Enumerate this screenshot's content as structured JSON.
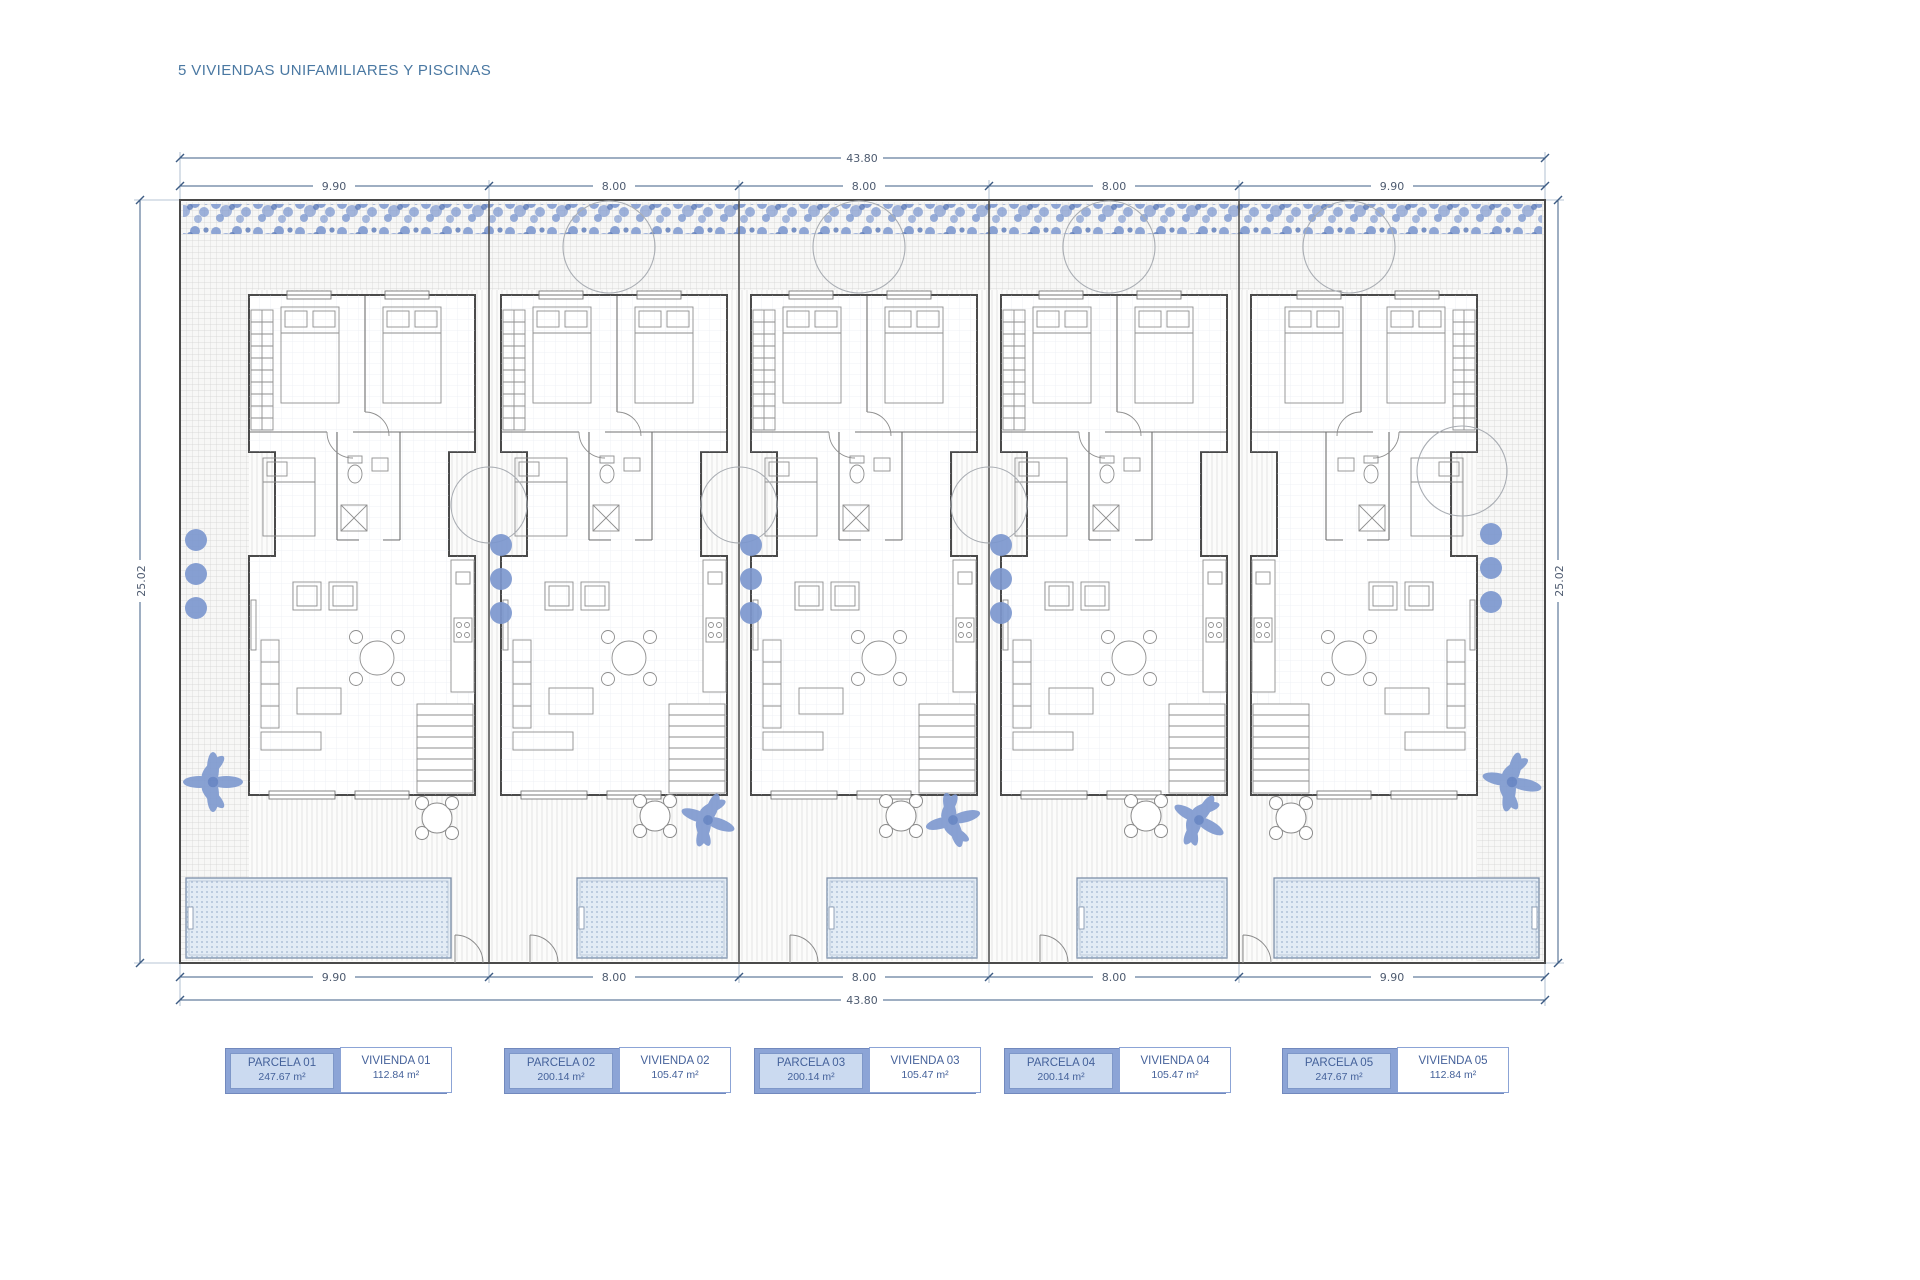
{
  "title": "5 VIVIENDAS UNIFAMILIARES Y PISCINAS",
  "dimensions": {
    "total_top": "43.80",
    "total_bottom": "43.80",
    "side_left": "25.02",
    "side_right": "25.02",
    "segments_top": [
      "9.90",
      "8.00",
      "8.00",
      "8.00",
      "9.90"
    ],
    "segments_bottom": [
      "9.90",
      "8.00",
      "8.00",
      "8.00",
      "9.90"
    ]
  },
  "legend": {
    "items": [
      {
        "parcela_label": "PARCELA 01",
        "parcela_area": "247.67 m²",
        "vivienda_label": "VIVIENDA 01",
        "vivienda_area": "112.84 m²"
      },
      {
        "parcela_label": "PARCELA 02",
        "parcela_area": "200.14 m²",
        "vivienda_label": "VIVIENDA 02",
        "vivienda_area": "105.47 m²"
      },
      {
        "parcela_label": "PARCELA 03",
        "parcela_area": "200.14 m²",
        "vivienda_label": "VIVIENDA 03",
        "vivienda_area": "105.47 m²"
      },
      {
        "parcela_label": "PARCELA 04",
        "parcela_area": "200.14 m²",
        "vivienda_label": "VIVIENDA 04",
        "vivienda_area": "105.47 m²"
      },
      {
        "parcela_label": "PARCELA 05",
        "parcela_area": "247.67 m²",
        "vivienda_label": "VIVIENDA 05",
        "vivienda_area": "112.84 m²"
      }
    ]
  },
  "colors": {
    "vegetation_blue": "#7d98cf",
    "pool_fill": "#e3ecf5",
    "legend_fill": "#8ca4d6",
    "legend_parcela_fill": "#cbdaf0",
    "dimension_line": "#3d5c84",
    "title_text": "#4a78a2"
  }
}
